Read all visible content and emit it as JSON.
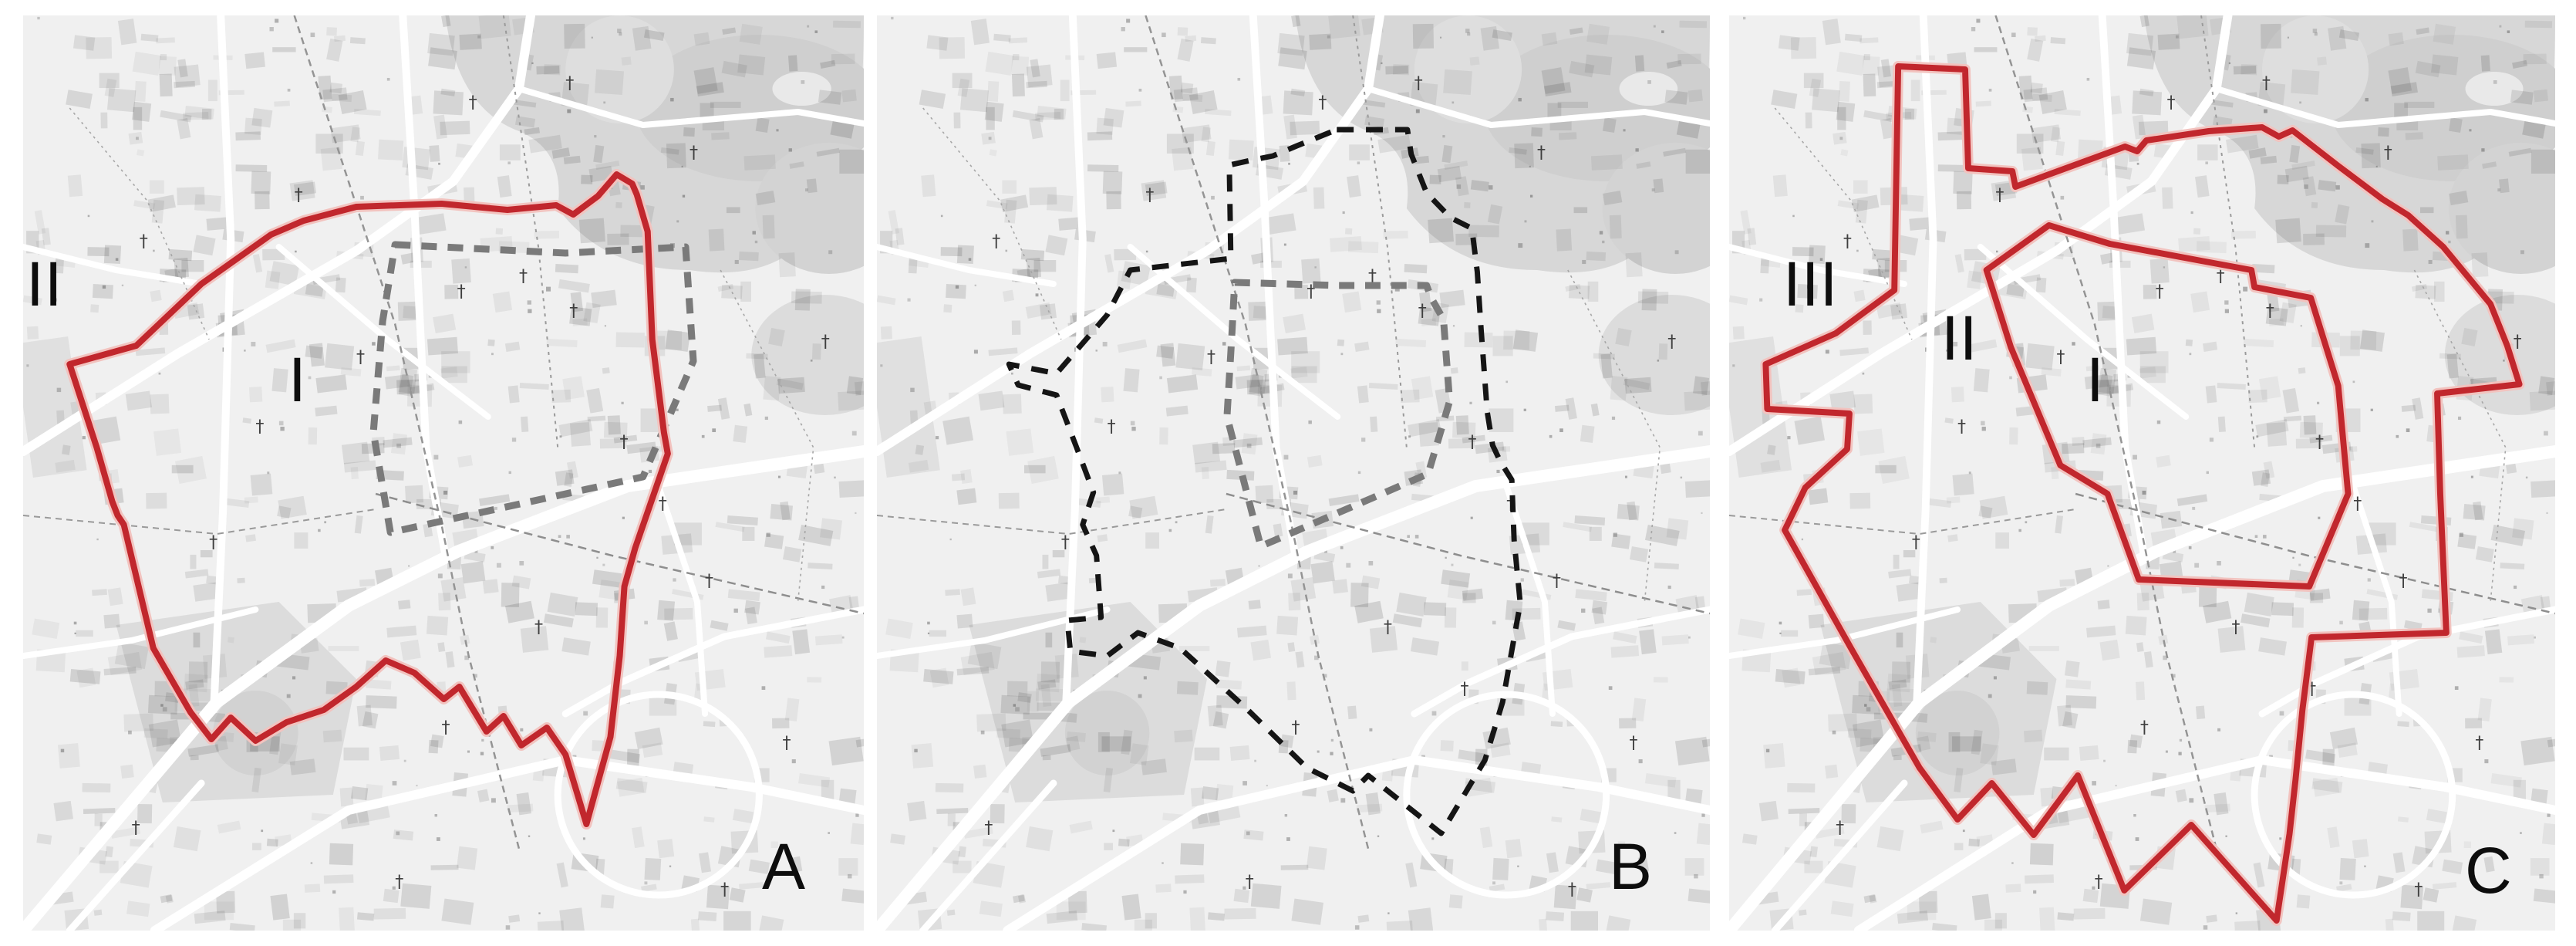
{
  "figure": {
    "description": "Three identical grayscale city-map panels with outlined urban zones",
    "panels": {
      "a": {
        "letter": "A",
        "numeral_i": "I",
        "numeral_ii": "II"
      },
      "b": {
        "letter": "B"
      },
      "c": {
        "letter": "C",
        "numeral_i": "I",
        "numeral_ii": "II",
        "numeral_iii": "III"
      }
    }
  },
  "colors": {
    "boundary_red": "#c1272d",
    "boundary_red_halo": "#f2c3bf",
    "boundary_black": "#151515",
    "boundary_gray": "#7a7a7a",
    "label_color": "#0d0d0d",
    "map_background": "#f0f0f0",
    "park_gray": "#d7d7d7"
  },
  "boundaries": {
    "a_outer": "60,452 146,428 230,348 320,284 362,266 430,248 540,244 625,252 688,246 710,258 742,234 766,206 786,218 792,232 806,280 812,420 827,540 832,568 790,690 776,740 770,830 758,935 727,1048 700,958 676,923 643,946 620,908 598,928 563,870 543,886 505,852 468,836 430,870 388,900 340,916 300,940 268,910 243,938 216,903 168,820 130,660 122,648 115,630 95,560",
    "a_inner": "480,297 700,308 855,300 865,448 800,598 474,670 452,540 464,396",
    "b_outer": "599,148 691,148 696,180 716,230 747,262 775,276 782,332 787,407 795,514 802,557 812,578 827,602 830,680 838,762 815,890 792,965 735,1060 640,985 620,1005 560,975 480,897 395,820 340,800 300,830 252,824 248,784 292,780 286,700 268,660 282,618 262,565 234,492 184,479 172,452 234,464 300,388 330,330 461,315 459,194 486,188 516,182 547,169",
    "b_inner": "466,346 600,350 716,350 722,366 738,394 746,500 718,594 500,688 456,520 462,420",
    "c_outer": "222,66 310,70 314,198 372,202 376,222 520,170 536,176 548,162 630,150 700,145 722,157 740,149 800,195 858,238 892,259 938,300 1000,374 1022,428 1038,478 930,490 934,620 942,800 765,806 753,900 744,990 736,1061 719,1173 607,1049 519,1134 458,985 400,1062 345,995 300,1042 250,975 160,820 73,667 100,612 155,562 158,516 50,510 48,452 140,412 217,356",
    "c_inner": "420,272 500,296 620,318 686,330 690,352 764,366 800,480 813,620 762,740 538,731 497,620 435,583 370,430 338,330"
  }
}
